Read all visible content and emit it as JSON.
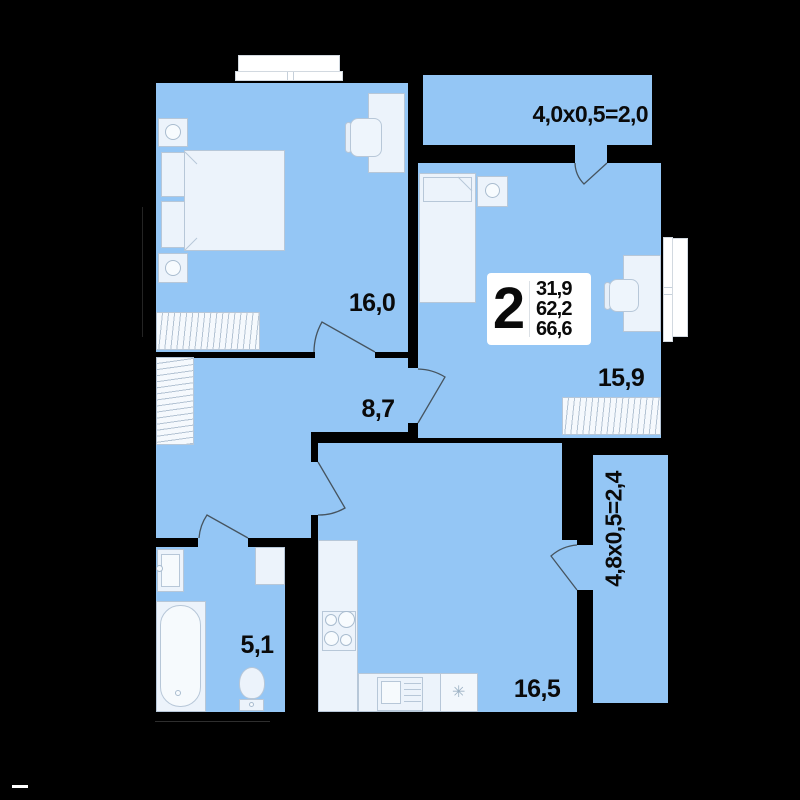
{
  "floorplan": {
    "kind": "apartment floor plan",
    "badge": {
      "rooms_count": "2",
      "areas": [
        "31,9",
        "62,2",
        "66,6"
      ]
    },
    "room_labels": {
      "bedroom": "16,0",
      "hallway": "8,7",
      "bedroom2": "15,9",
      "bathroom": "5,1",
      "kitchen_living": "16,5"
    },
    "balcony_labels": {
      "top": "4,0x0,5=2,0",
      "right": "4,8x0,5=2,4"
    },
    "appliance_symbol": "✳",
    "colors": {
      "background": "#000000",
      "room_fill": "#94c6f5",
      "furniture_fill": "#ecf3fb",
      "furniture_stroke": "#b7c7d8",
      "window_fill": "#ffffff",
      "door_arc": "#46545f",
      "badge_bg": "#ffffff",
      "label_text": "#0a0a0a"
    }
  }
}
